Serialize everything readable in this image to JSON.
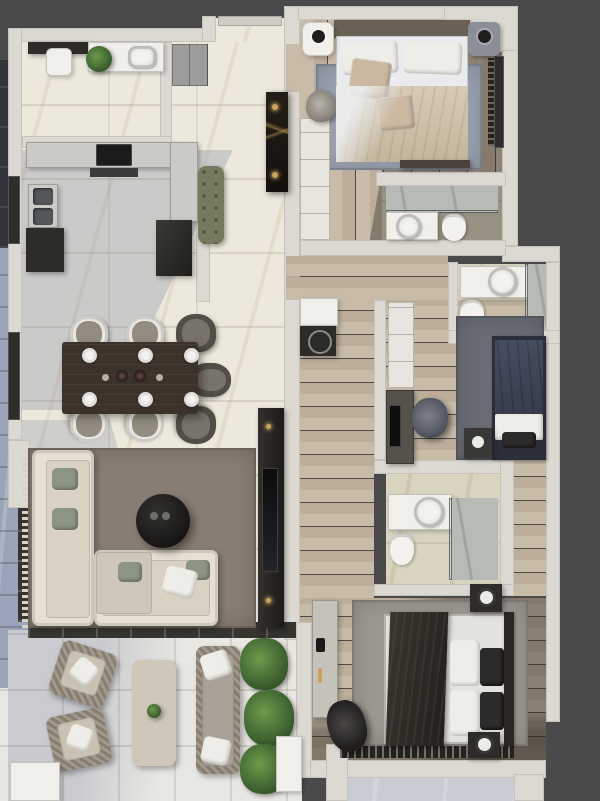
{
  "scene": {
    "type": "architectural-floor-plan-3d-render",
    "view": "top-down",
    "visible_text": "none",
    "units_shown": "none"
  },
  "palette": {
    "bg": "#4a4a4b",
    "wall": "#dcd8d2",
    "marble": "#ece8dc",
    "bath": "#d9d4c0",
    "stone": "#b7bbb5",
    "wood1": "#c8bba8",
    "wood2": "#bcae9a",
    "terr": "#e9e7e2",
    "balc": "#9aa3b7",
    "counter": "#cbcac6",
    "white": "#f0efea",
    "charcoal": "#2e2c29",
    "cream": "#e6e0d3",
    "seat": "#d9d2c2",
    "green": "#8d9584",
    "bench": "#75795d",
    "tablewood": "#3c322a",
    "gold": "#c9a25c",
    "rug_living": "#887d73",
    "rug_blue": "#9aa1af",
    "rug_gray": "#9c9890",
    "navy_bed": "#3e4454",
    "plant": "#46632f"
  },
  "rooms": [
    {
      "id": "utility-room",
      "label": "Utility Room",
      "floor": "marble"
    },
    {
      "id": "kitchen",
      "label": "Kitchen",
      "floor": "marble"
    },
    {
      "id": "entry-hall",
      "label": "Entry Hall",
      "floor": "marble"
    },
    {
      "id": "dining-area",
      "label": "Dining Area",
      "floor": "marble"
    },
    {
      "id": "living-room",
      "label": "Living Room",
      "floor": "marble"
    },
    {
      "id": "terrace",
      "label": "Terrace",
      "floor": "tile"
    },
    {
      "id": "side-balcony",
      "label": "Side Balcony",
      "floor": "blue-tile"
    },
    {
      "id": "master-bedroom",
      "label": "Master Bedroom",
      "floor": "wood"
    },
    {
      "id": "ensuite-bathroom",
      "label": "Ensuite Bathroom",
      "floor": "stone"
    },
    {
      "id": "bathroom-2",
      "label": "Bathroom 2",
      "floor": "stone"
    },
    {
      "id": "bedroom-2",
      "label": "Bedroom 2",
      "floor": "wood"
    },
    {
      "id": "corridor",
      "label": "Corridor",
      "floor": "wood"
    },
    {
      "id": "bathroom-3",
      "label": "Bathroom 3",
      "floor": "stone"
    },
    {
      "id": "bedroom-3",
      "label": "Bedroom 3",
      "floor": "wood"
    },
    {
      "id": "rear-balcony",
      "label": "Rear Balcony",
      "floor": "tile"
    }
  ],
  "furniture": {
    "utility-room": [
      "sink-counter",
      "sink",
      "potted-plant",
      "stool",
      "dark-cabinet"
    ],
    "kitchen": [
      "l-shaped-counter",
      "cooktop",
      "extractor-vent",
      "double-sink",
      "oven-column",
      "refrigerator",
      "green-tufted-bench",
      "tall-gray-cabinet"
    ],
    "entry-hall": [
      "dark-marble-console",
      "candle-lights"
    ],
    "dining-area": [
      "dark-wood-dining-table",
      "white-chairs-x4",
      "dark-chairs-x3",
      "place-settings-x6",
      "centerpiece-vases"
    ],
    "living-room": [
      "l-shaped-cream-sectional-sofa",
      "green-accent-pillows",
      "round-black-coffee-table",
      "area-rug",
      "tv-media-wall"
    ],
    "terrace": [
      "wicker-lounge-chair-x2",
      "wicker-coffee-table",
      "wicker-sofa",
      "planter-plants",
      "white-planter-box"
    ],
    "master-bedroom": [
      "double-bed",
      "white-pillows",
      "tan-accent-cushions",
      "nightstand-x2",
      "table-lamps",
      "wardrobe",
      "armchair",
      "blue-gray-rug",
      "foot-bench"
    ],
    "ensuite-bathroom": [
      "walk-in-shower",
      "round-vessel-sink",
      "toilet"
    ],
    "bathroom-2": [
      "vanity-counter",
      "round-vessel-sink",
      "toilet",
      "shower"
    ],
    "bedroom-2": [
      "navy-bed",
      "nightstand-lamp",
      "wardrobe",
      "desk-with-monitor",
      "desk-chair",
      "dark-rug"
    ],
    "corridor": [
      "closet-cabinet",
      "washing-machine"
    ],
    "bathroom-3": [
      "vanity-counter",
      "round-vessel-sink",
      "toilet",
      "walk-in-shower"
    ],
    "bedroom-3": [
      "double-bed",
      "dark-throw",
      "white-pillows",
      "nightstand-x2",
      "lamps",
      "gray-rug",
      "desk",
      "office-chair",
      "curtained-window"
    ]
  }
}
